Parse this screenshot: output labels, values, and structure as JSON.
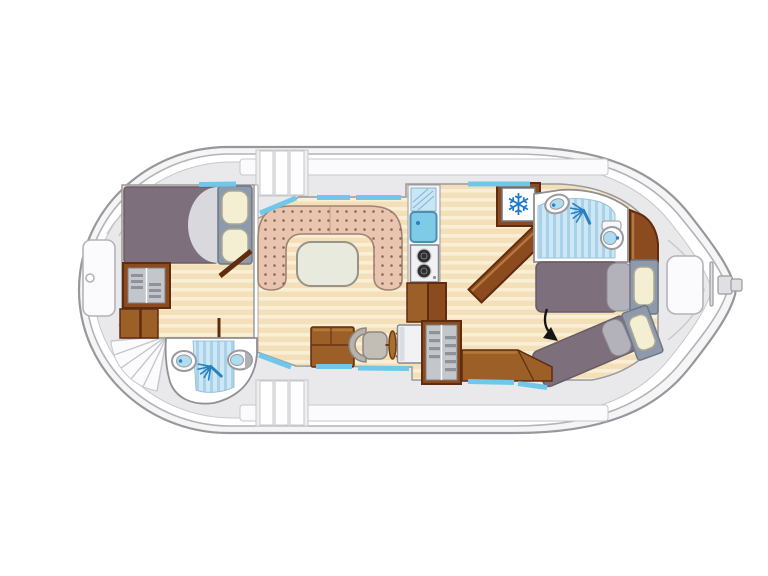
{
  "icons": {
    "snowflake": "❄"
  },
  "palette": {
    "hull-outline": "#98989C",
    "hull-band": "#F5F5F7",
    "hull-line2": "#B3B3B8",
    "hull-white": "#FFFFFF",
    "deck": "#E9E9EC",
    "deck-line": "#C7C7CC",
    "walkway": "#FBFBFD",
    "panel": "#EFEFF2",
    "room-wall": "#8F8F94",
    "floor-edge": "#9A9A9F",
    "wood-base": "#F4E0B8",
    "wood-stripe": "#FAEFD6",
    "bath-base": "#CDE7F5",
    "bath-stripe": "#A9D2E8",
    "bath-edge": "#9BC2DA",
    "bed-purple": "#7D707C",
    "bed-purple-edge": "#675C66",
    "sheet": "#D9D9DD",
    "slate": "#8E99AB",
    "slate-edge": "#6E7789",
    "cream": "#F4EFD3",
    "cream-edge": "#ABA893",
    "duvet": "#B3B1BA",
    "duvet-edge": "#8C8A93",
    "pink": "#E9C4AF",
    "pink-dot": "#8A675C",
    "pink-edge": "#A08374",
    "pink-seam": "#C89B86",
    "table": "#E8EADD",
    "table-edge": "#97938A",
    "brown": "#8C4A1F",
    "brown-mid": "#9C5F28",
    "brown-dark": "#5F2C10",
    "brown-hi": "#B5783B",
    "cab-gray": "#C3C6CB",
    "cab-slat": "#8F9298",
    "cab-edge": "#7E8187",
    "cyan": "#6FC8E9",
    "white": "#FCFCFD",
    "metal": "#9A9A9F",
    "fixture": "#AEDCF0",
    "fixture-dot": "#2A7FBF",
    "blue-icon": "#2A7FBF",
    "snow": "#1F78C8",
    "counter": "#F7F7F9",
    "drainer": "#C9E6F4",
    "drainer-edge": "#8FB4C8",
    "drainer-line": "#7FB4D4",
    "sink-blue": "#7ECBE8",
    "sink-edge": "#4E8FB0",
    "stove": "#F2F2F4",
    "stove-edge": "#88888D",
    "burner": "#2E2E31",
    "burner-ring": "#C9C9CE",
    "burner-in": "#77777C",
    "chair": "#B7B3AB",
    "chair2": "#C2BEB5",
    "chair-edge": "#8A8780",
    "wheel": "#A96F2E",
    "wheel-edge": "#6B3A12",
    "console-shade": "#D9DCE0",
    "tiller": "#E0E0E4",
    "lid": "#AFAFB6",
    "arrow": "#151515"
  }
}
